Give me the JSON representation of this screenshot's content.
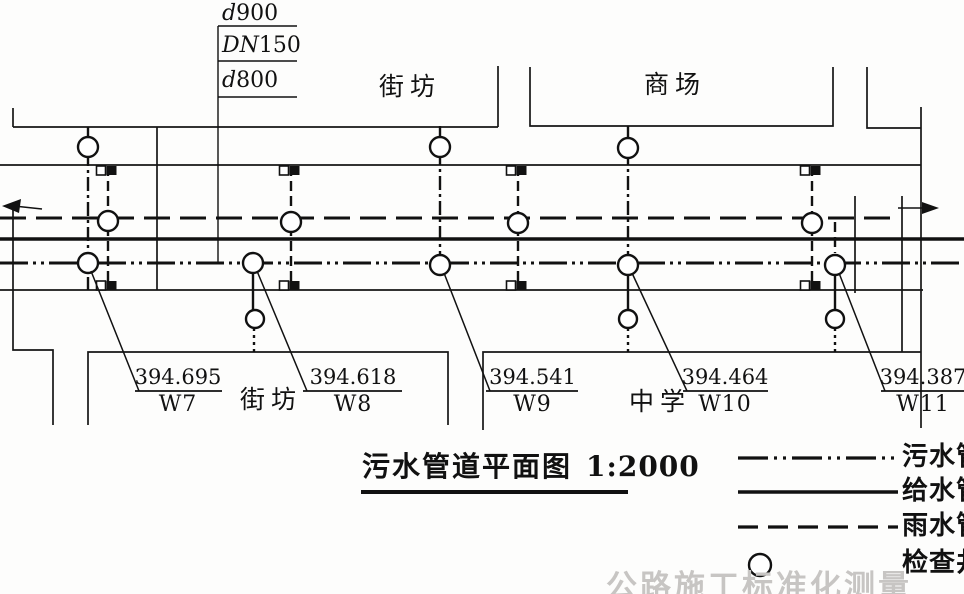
{
  "diameter_labels": {
    "rain": {
      "prefix": "d",
      "value": "900"
    },
    "water": {
      "prefix": "DN",
      "value": "150"
    },
    "sewage": {
      "prefix": "d",
      "value": "800"
    }
  },
  "blocks": {
    "top_left": "街坊",
    "top_right": "商场",
    "bottom_left": "街坊",
    "bottom_right": "中学"
  },
  "wells": [
    {
      "name": "W7",
      "elevation": "394.695"
    },
    {
      "name": "W8",
      "elevation": "394.618"
    },
    {
      "name": "W9",
      "elevation": "394.541"
    },
    {
      "name": "W10",
      "elevation": "394.464"
    },
    {
      "name": "W11",
      "elevation": "394.387"
    }
  ],
  "title": {
    "text": "污水管道平面图",
    "scale": "1:2000"
  },
  "legend": {
    "items": [
      {
        "label": "污水管",
        "style": "dash-dot-dot"
      },
      {
        "label": "给水管",
        "style": "solid"
      },
      {
        "label": "雨水管",
        "style": "dashed"
      },
      {
        "label": "检查井",
        "style": "circle"
      }
    ]
  },
  "watermark": "公路施工标准化测量"
}
